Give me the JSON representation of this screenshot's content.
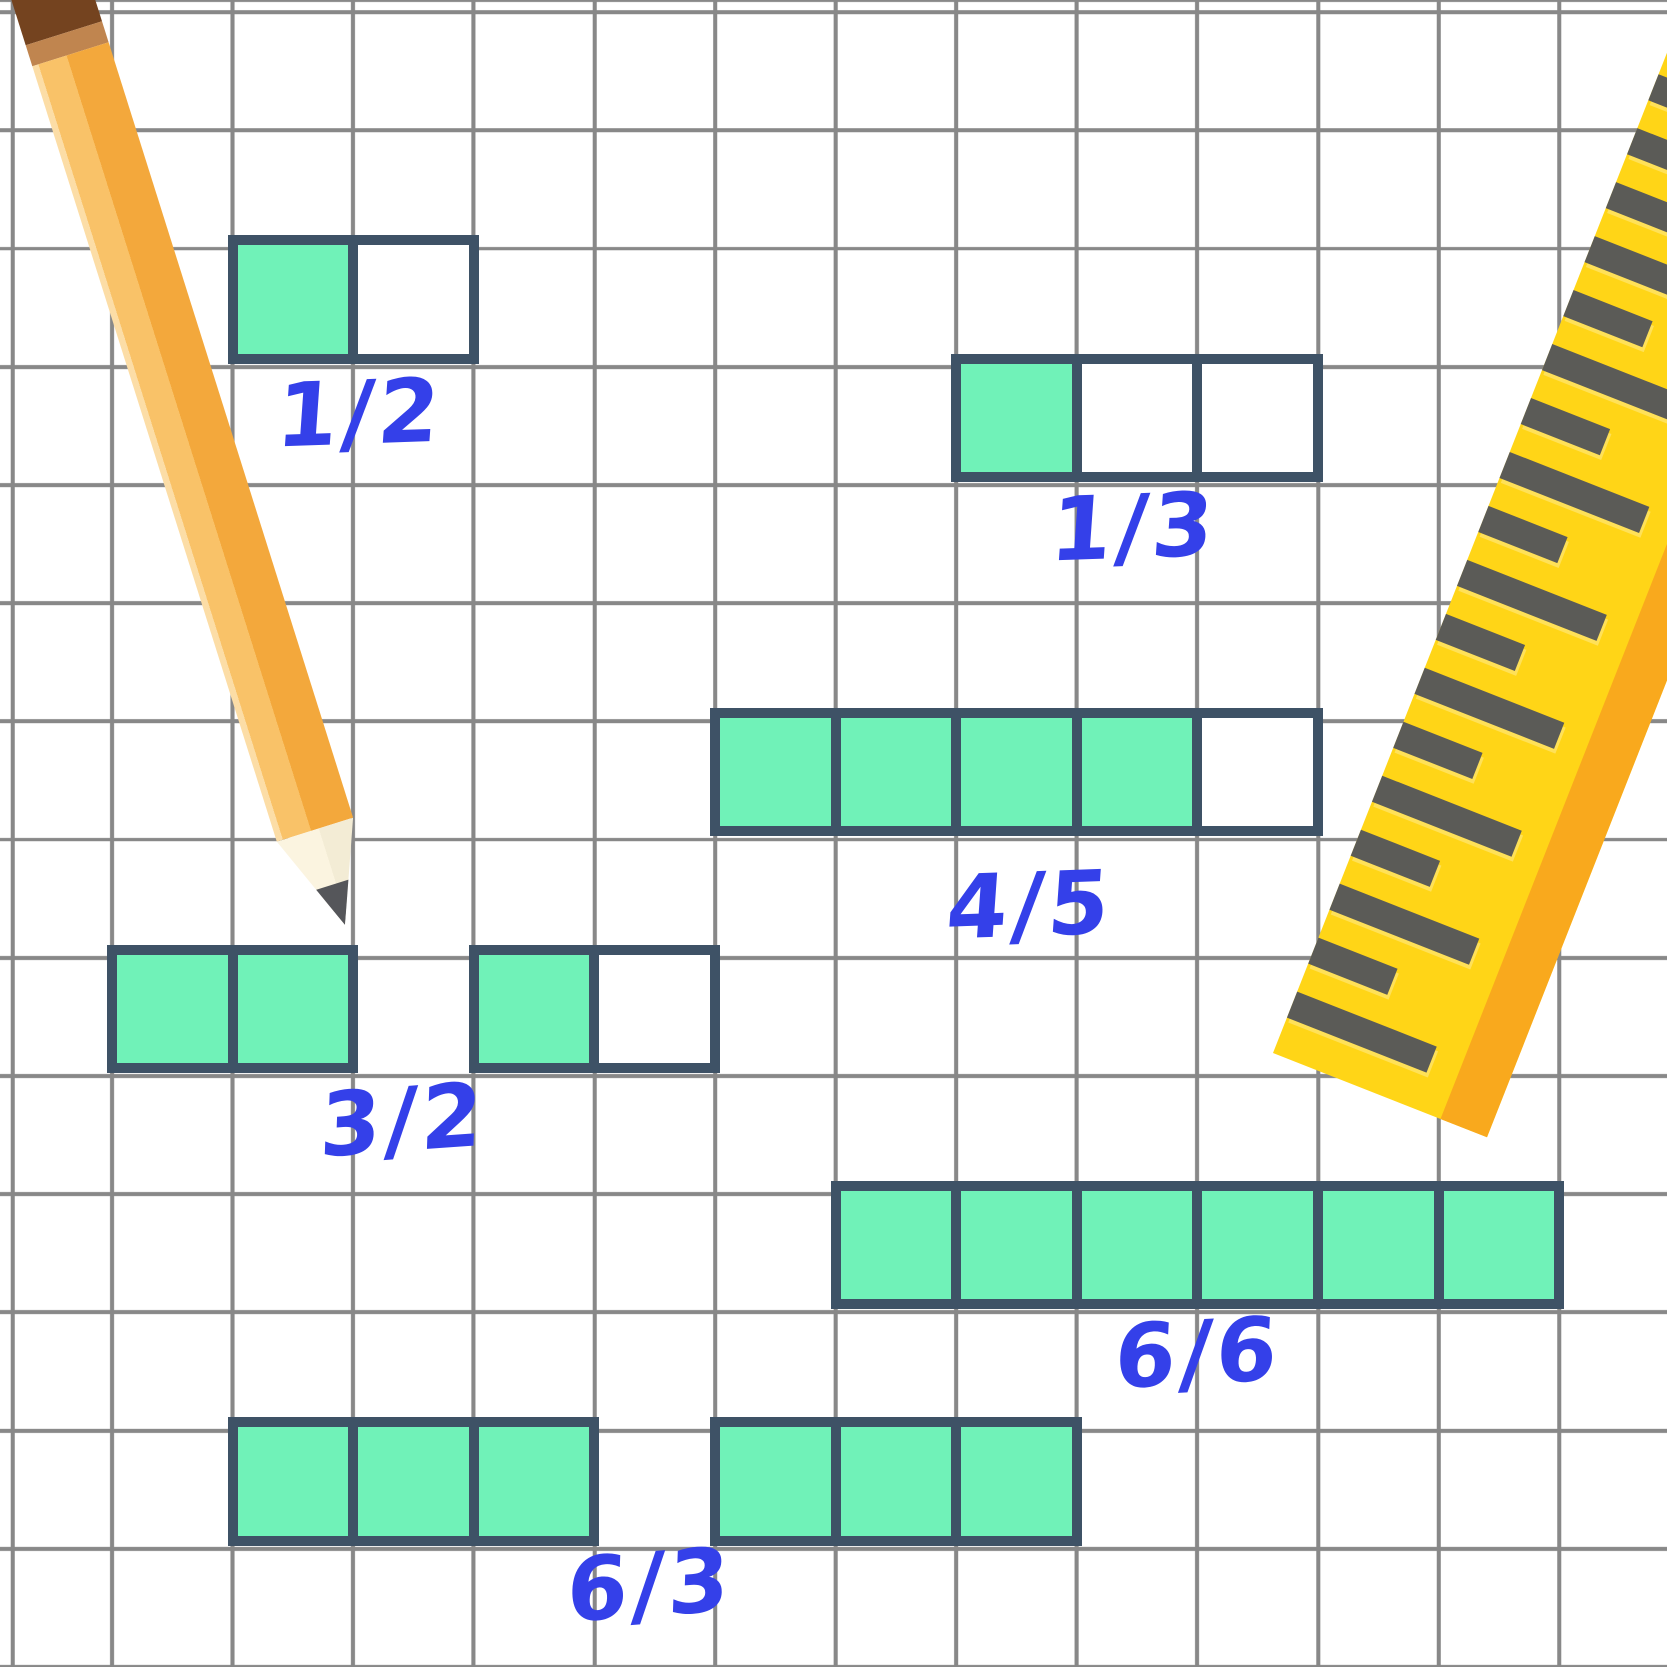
{
  "canvas": {
    "width": 1667,
    "height": 1667,
    "background": "#ffffff"
  },
  "grid": {
    "line_color": "#888888",
    "line_width": 4,
    "spacing_x": 120.6,
    "spacing_y": 118.2,
    "offset_x": 110,
    "offset_y": 2
  },
  "colors": {
    "bg": "#ffffff",
    "bar-border": "#3e5266",
    "bar-fill": "#70f2b8",
    "bar-empty": "#ffffff",
    "ink": "#3440e9",
    "pencil-cap": "#74431f",
    "pencil-band": "#c0854f",
    "pencil-facet1": "#fcdda6",
    "pencil-facet2": "#f9c268",
    "pencil-facet3": "#f3a83c",
    "pencil-wood": "#fbf4e0",
    "pencil-wood2": "#f3ecd5",
    "pencil-lead": "#55565a",
    "ruler-yellow": "#ffd517",
    "ruler-orange": "#f9a91d",
    "ruler-tick": "#5b5b57",
    "ruler-tick-shadow": "#ffe158"
  },
  "bar_geometry": {
    "cell_inner_width": 110.6,
    "cell_inner_height": 108.2,
    "divider": 10,
    "border": 10
  },
  "models": [
    {
      "label": "1/2",
      "numerator": 1,
      "denominator": 2,
      "bars": [
        {
          "x": 227.6,
          "y": 235.4,
          "cells": [
            1,
            0
          ]
        }
      ],
      "label_x": 360,
      "label_y": 413,
      "label_tilt": -2
    },
    {
      "label": "1/3",
      "numerator": 1,
      "denominator": 3,
      "bars": [
        {
          "x": 951.2,
          "y": 353.6,
          "cells": [
            1,
            0,
            0
          ]
        }
      ],
      "label_x": 1134,
      "label_y": 527,
      "label_tilt": -2
    },
    {
      "label": "4/5",
      "numerator": 4,
      "denominator": 5,
      "bars": [
        {
          "x": 710,
          "y": 708.2,
          "cells": [
            1,
            1,
            1,
            1,
            0
          ]
        }
      ],
      "label_x": 1030,
      "label_y": 905,
      "label_tilt": -2
    },
    {
      "label": "3/2",
      "numerator": 3,
      "denominator": 2,
      "bars": [
        {
          "x": 107,
          "y": 944.6,
          "cells": [
            1,
            1
          ]
        },
        {
          "x": 468.8,
          "y": 944.6,
          "cells": [
            1,
            0
          ]
        }
      ],
      "label_x": 403,
      "label_y": 1120,
      "label_tilt": -4
    },
    {
      "label": "6/6",
      "numerator": 6,
      "denominator": 6,
      "bars": [
        {
          "x": 830.6,
          "y": 1181,
          "cells": [
            1,
            1,
            1,
            1,
            1,
            1
          ]
        }
      ],
      "label_x": 1198,
      "label_y": 1353,
      "label_tilt": -3
    },
    {
      "label": "6/3",
      "numerator": 6,
      "denominator": 3,
      "bars": [
        {
          "x": 227.6,
          "y": 1417.4,
          "cells": [
            1,
            1,
            1
          ]
        },
        {
          "x": 710,
          "y": 1417.4,
          "cells": [
            1,
            1,
            1
          ]
        }
      ],
      "label_x": 650,
      "label_y": 1585,
      "label_tilt": -4
    }
  ],
  "ruler": {
    "tick_count": 23,
    "tick_spacing": 58,
    "tick_long": 150,
    "tick_short": 85,
    "tick_thickness": 28,
    "first_tick_offset_from_bottom": 52
  }
}
